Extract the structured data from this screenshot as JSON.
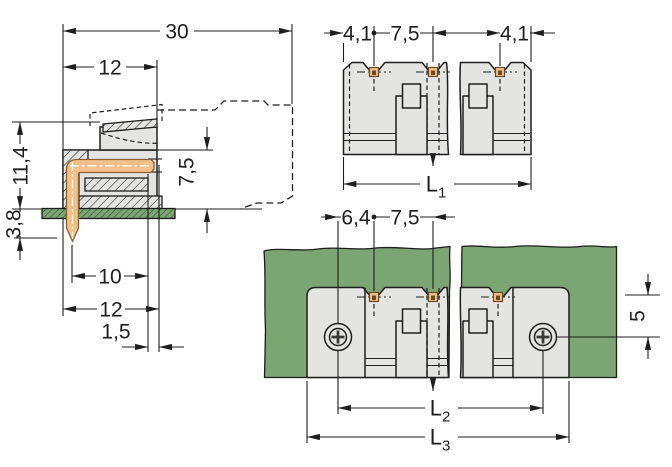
{
  "drawing": {
    "title": "connector-dimension-drawing",
    "side": {
      "d30": "30",
      "d12_top": "12",
      "d11_4": "11,4",
      "d3_8": "3,8",
      "d7_5": "7,5",
      "d10": "10",
      "d12_bottom": "12",
      "d1_5": "1,5"
    },
    "top": {
      "d4_1_left": "4,1",
      "d7_5": "7,5",
      "d4_1_right": "4,1",
      "L1": {
        "main": "L",
        "sub": "1"
      }
    },
    "pcb": {
      "d6_4": "6,4",
      "d7_5": "7,5",
      "d5": "5",
      "L2": {
        "main": "L",
        "sub": "2"
      },
      "L3": {
        "main": "L",
        "sub": "3"
      }
    },
    "colors": {
      "line": "#1e1e1e",
      "body_gray": "#e4e5e2",
      "pcb_green": "#7ba572",
      "pcb_hatch": "#2c4d28",
      "pin_orange": "#f3c08b",
      "pin_outline": "#8a5f2e"
    }
  }
}
